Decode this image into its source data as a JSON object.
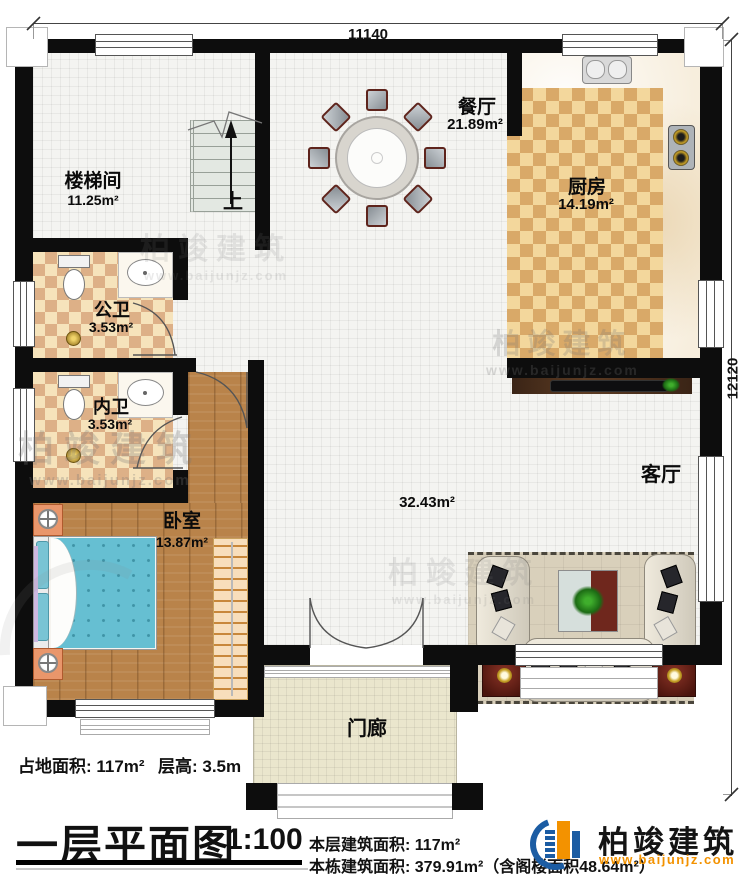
{
  "dimensions": {
    "top": "11140",
    "right": "12120"
  },
  "rooms": {
    "stairwell": {
      "name": "楼梯间",
      "area": "11.25m²"
    },
    "dining": {
      "name": "餐厅",
      "area": "21.89m²"
    },
    "kitchen": {
      "name": "厨房",
      "area": "14.19m²"
    },
    "public_bath": {
      "name": "公卫",
      "area": "3.53m²"
    },
    "inner_bath": {
      "name": "内卫",
      "area": "3.53m²"
    },
    "bedroom": {
      "name": "卧室",
      "area": "13.87m²"
    },
    "living": {
      "name": "客厅",
      "area": "32.43m²"
    },
    "porch": {
      "name": "门廊"
    }
  },
  "stairs": {
    "up_label": "上"
  },
  "title_block": {
    "land_area": "占地面积: 117m²",
    "floor_height": "层高: 3.5m",
    "plan_title": "一层平面图",
    "scale": "1:100",
    "floor_area": "本层建筑面积: 117m²",
    "building_area": "本栋建筑面积: 379.91m²（含阁楼面积48.64m²）"
  },
  "brand": {
    "name": "柏竣建筑",
    "url": "www.baijunjz.com"
  },
  "watermark": {
    "name": "柏竣建筑",
    "url": "www.baijunjz.com"
  },
  "colors": {
    "wall": "#0d0d0d",
    "tile_light": "#f6e3bb",
    "tile_dark": "#ddb087",
    "ktile_light": "#f3d79c",
    "ktile_dark": "#d9a968",
    "marble": "#f7eedd",
    "wood": "#b9834a",
    "porch": "#eae6cd",
    "bed_blue": "#66bfd2",
    "rug": "#d9d0bb",
    "brand_blue": "#1b5ca3",
    "brand_orange": "#f39200"
  }
}
